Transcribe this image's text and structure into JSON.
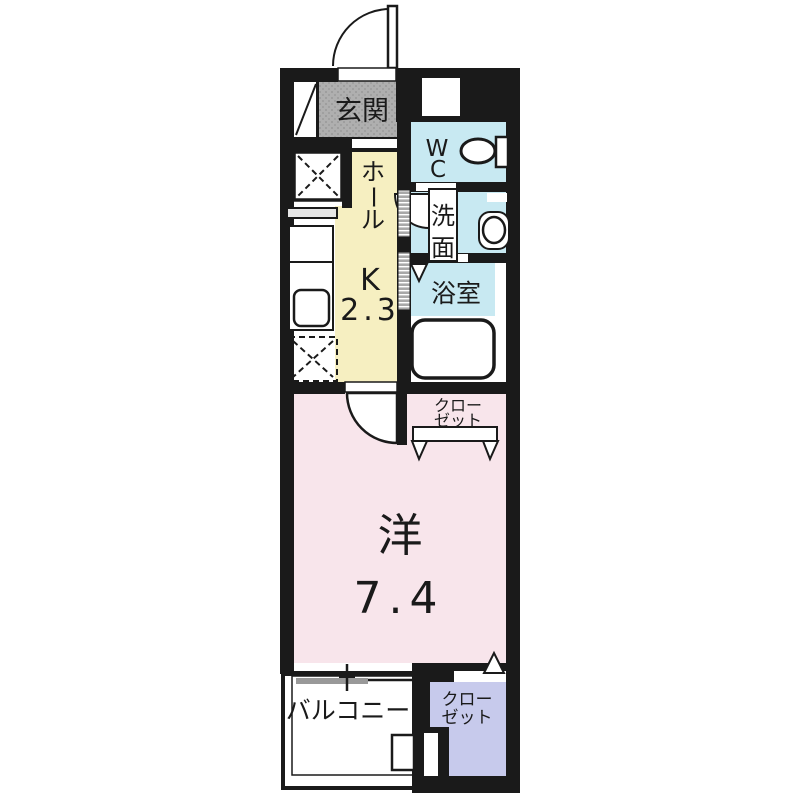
{
  "title": "apartment-floor-plan",
  "colors": {
    "wall": "#1A1A1A",
    "hall_yellow": "#F6EFC1",
    "room_pink": "#F8E5EB",
    "wet_cyan": "#C8E9F2",
    "closet_lavender": "#C7CAEC",
    "entrance_gray": "#AFAFAF"
  },
  "rooms": {
    "entrance": {
      "label": "玄関"
    },
    "wc": {
      "line1": "W",
      "line2": "C"
    },
    "washroom": {
      "char1": "洗",
      "char2": "面"
    },
    "bathroom": {
      "label": "浴室"
    },
    "hall": {
      "char1": "ホ",
      "char2": "ー",
      "char3": "ル"
    },
    "kitchen": {
      "label": "K",
      "size": "2.3"
    },
    "closet_mid": {
      "line1": "クロー",
      "line2": "ゼット"
    },
    "western": {
      "label": "洋",
      "size": "7.4"
    },
    "balcony": {
      "label": "バルコニー"
    },
    "closet_bottom": {
      "line1": "クロー",
      "line2": "ゼット"
    }
  }
}
